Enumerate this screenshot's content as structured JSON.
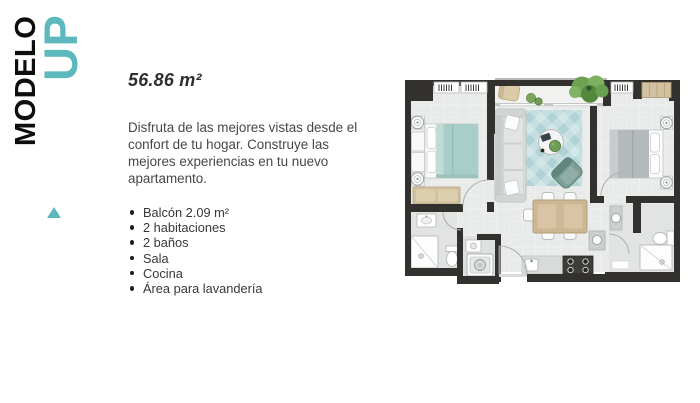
{
  "brand": {
    "model_label": "MODELO",
    "model_name": "UP"
  },
  "content": {
    "area_title": "56.86 m²",
    "description": "Disfruta de las mejores vistas desde el confort de tu hogar. Construye las mejores experiencias en tu nuevo apartamento.",
    "features": [
      "Balcón 2.09 m²",
      "2 habitaciones",
      "2 baños",
      "Sala",
      "Cocina",
      "Área para lavandería"
    ]
  },
  "icons": {
    "marker": "triangle-up"
  },
  "colors": {
    "accent_teal": "#5cb8bc",
    "title_black": "#0d0d0d",
    "plan_wall": "#33312e"
  }
}
